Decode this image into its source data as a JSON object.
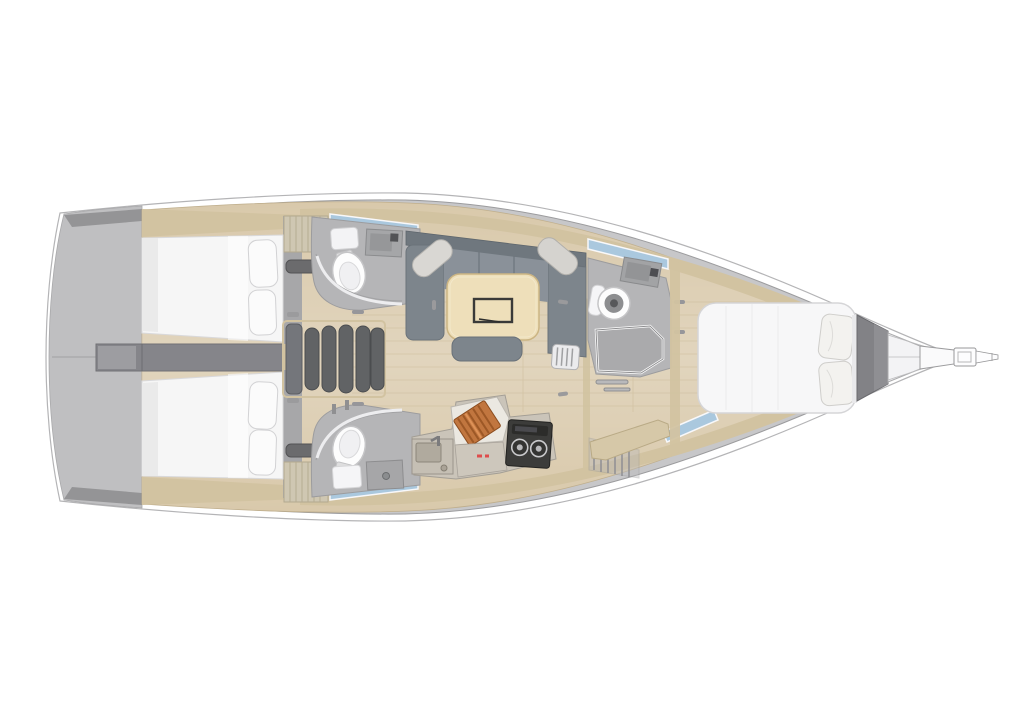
{
  "figure": {
    "type": "yacht-interior-floor-plan",
    "view": "top-down",
    "orientation": {
      "bow": "right",
      "stern": "left"
    },
    "background": "#ffffff"
  },
  "palette": {
    "hull_outline": "#b4b4b6",
    "deck_gray": "#c7c7c9",
    "transom_gray": "#bfbfc1",
    "dark_gray": "#85858a",
    "wood_floor": "#d9c9ab",
    "wood_trim": "#d2c3a1",
    "plank_line": "#c8b794",
    "mattress_white": "#f6f6f6",
    "pillow_white": "#fbfbfb",
    "upholstery_gray": "#7d858c",
    "upholstery_dark": "#6f777e",
    "seat_gray": "#8a9199",
    "table_wood": "#eedfba",
    "head_gray": "#b5b5b7",
    "fixture_white": "#fdfdfd",
    "window_blue": "#aac8de",
    "stairs_gray": "#616365",
    "stove_black": "#3c3c3a",
    "copper": "#c1763f",
    "accent_red": "#e04040"
  },
  "components": {
    "aft_cabins": 2,
    "aft_cabin_features": [
      "double-berth",
      "two-pillows",
      "wood-trim-shelf"
    ],
    "heads": 3,
    "head_features": [
      "toilet",
      "sink",
      "shower"
    ],
    "salon": [
      "u-shaped-sofa",
      "two-bolster-pillows",
      "dining-table",
      "sunken-tray",
      "bench-seat",
      "folding-stool"
    ],
    "galley": {
      "burners": 2,
      "items": [
        "sink",
        "faucet",
        "stove",
        "cutting-board"
      ],
      "marking_color": "#e04040"
    },
    "forward_cabin": [
      "island-double-berth",
      "two-pillows"
    ],
    "companionway_steps": 5,
    "bow": [
      "anchor-locker",
      "bow-platform",
      "bowsprit"
    ],
    "hull_windows": 4,
    "transom": [
      "swim-platform",
      "centerline",
      "hatch-ring"
    ]
  }
}
